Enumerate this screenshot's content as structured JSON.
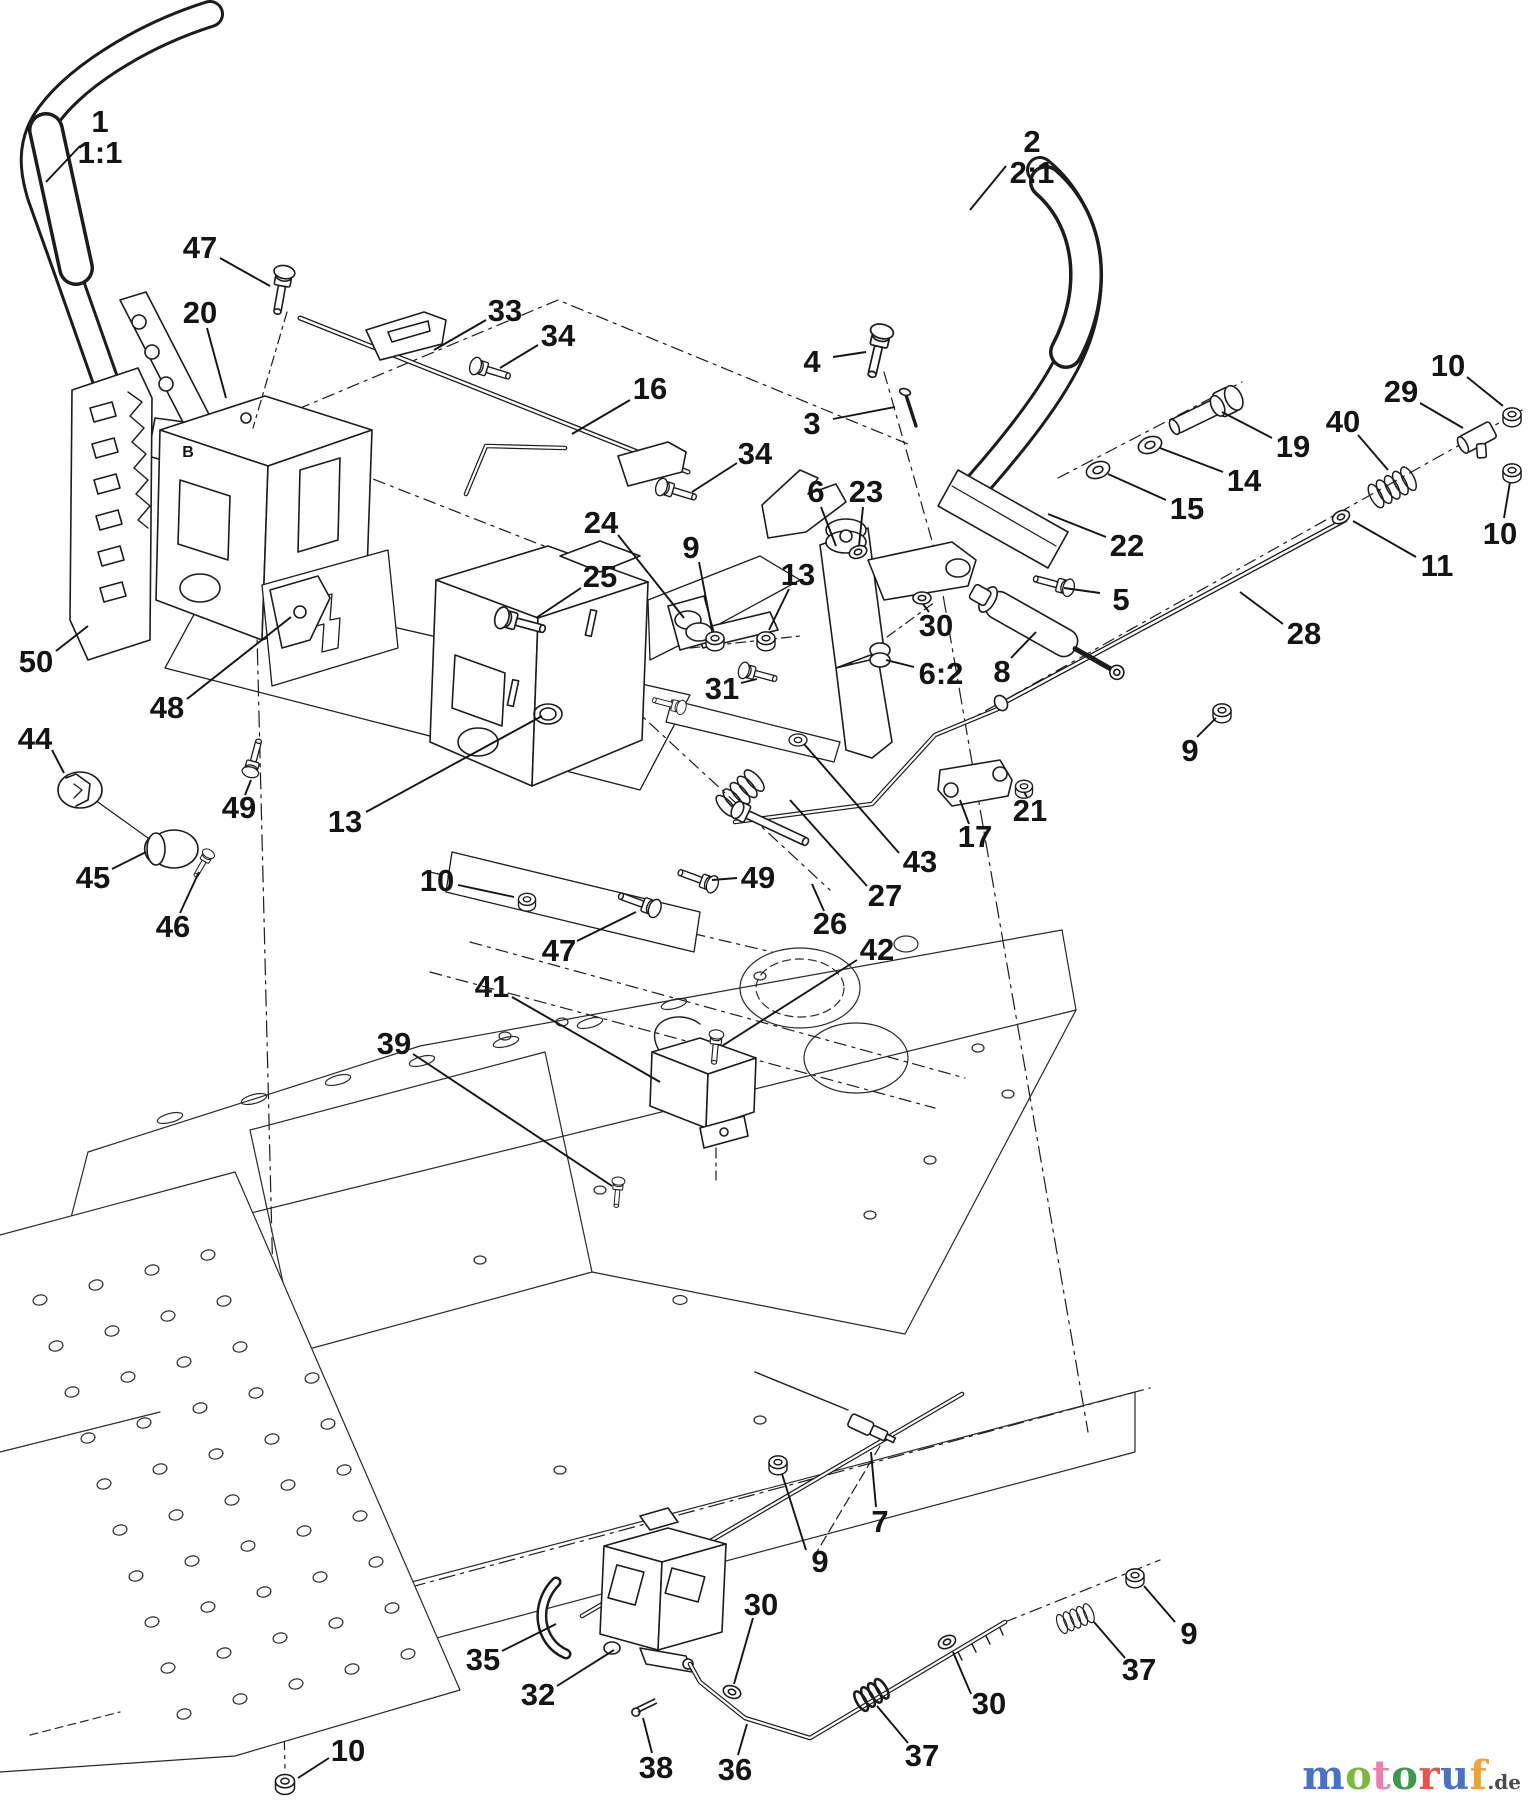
{
  "diagram": {
    "type": "exploded-parts-diagram",
    "background": "#ffffff",
    "line_color": "#1c1c1c",
    "callout_font_px": 31,
    "callouts": [
      {
        "id": "1",
        "lines": [
          "1",
          "1:1"
        ],
        "x": 100,
        "y": 122,
        "leader": [
          80,
          146,
          46,
          182
        ]
      },
      {
        "id": "2",
        "lines": [
          "2",
          "2:1"
        ],
        "x": 1032,
        "y": 142,
        "leader": [
          1006,
          166,
          970,
          210
        ]
      },
      {
        "id": "47a",
        "lines": [
          "47"
        ],
        "x": 200,
        "y": 248,
        "leader": [
          220,
          258,
          270,
          286
        ]
      },
      {
        "id": "20",
        "lines": [
          "20"
        ],
        "x": 200,
        "y": 313,
        "leader": [
          207,
          328,
          226,
          398
        ]
      },
      {
        "id": "33",
        "lines": [
          "33"
        ],
        "x": 505,
        "y": 311,
        "leader": [
          486,
          320,
          434,
          350
        ]
      },
      {
        "id": "34a",
        "lines": [
          "34"
        ],
        "x": 558,
        "y": 336,
        "leader": [
          538,
          345,
          500,
          368
        ]
      },
      {
        "id": "16",
        "lines": [
          "16"
        ],
        "x": 650,
        "y": 389,
        "leader": [
          630,
          400,
          572,
          434
        ]
      },
      {
        "id": "4",
        "lines": [
          "4"
        ],
        "x": 812,
        "y": 362,
        "leader": [
          833,
          357,
          866,
          352
        ]
      },
      {
        "id": "3",
        "lines": [
          "3"
        ],
        "x": 812,
        "y": 424,
        "leader": [
          833,
          419,
          895,
          407
        ]
      },
      {
        "id": "34b",
        "lines": [
          "34"
        ],
        "x": 755,
        "y": 454,
        "leader": [
          737,
          463,
          692,
          492
        ]
      },
      {
        "id": "19",
        "lines": [
          "19"
        ],
        "x": 1293,
        "y": 447,
        "leader": [
          1272,
          438,
          1222,
          412
        ]
      },
      {
        "id": "14",
        "lines": [
          "14"
        ],
        "x": 1244,
        "y": 481,
        "leader": [
          1223,
          472,
          1160,
          448
        ]
      },
      {
        "id": "15",
        "lines": [
          "15"
        ],
        "x": 1187,
        "y": 509,
        "leader": [
          1166,
          500,
          1108,
          474
        ]
      },
      {
        "id": "29",
        "lines": [
          "29"
        ],
        "x": 1401,
        "y": 392,
        "leader": [
          1420,
          403,
          1463,
          428
        ]
      },
      {
        "id": "10a",
        "lines": [
          "10"
        ],
        "x": 1448,
        "y": 366,
        "leader": [
          1467,
          377,
          1503,
          406
        ]
      },
      {
        "id": "40",
        "lines": [
          "40"
        ],
        "x": 1343,
        "y": 422,
        "leader": [
          1358,
          435,
          1388,
          470
        ]
      },
      {
        "id": "10b",
        "lines": [
          "10"
        ],
        "x": 1500,
        "y": 534,
        "leader": [
          1504,
          518,
          1510,
          482
        ]
      },
      {
        "id": "11",
        "lines": [
          "11"
        ],
        "x": 1437,
        "y": 566,
        "leader": [
          1416,
          557,
          1353,
          521
        ]
      },
      {
        "id": "28",
        "lines": [
          "28"
        ],
        "x": 1304,
        "y": 634,
        "leader": [
          1283,
          624,
          1240,
          592
        ]
      },
      {
        "id": "22",
        "lines": [
          "22"
        ],
        "x": 1127,
        "y": 546,
        "leader": [
          1106,
          537,
          1048,
          514
        ]
      },
      {
        "id": "5",
        "lines": [
          "5"
        ],
        "x": 1121,
        "y": 600,
        "leader": [
          1100,
          593,
          1064,
          588
        ]
      },
      {
        "id": "30a",
        "lines": [
          "30"
        ],
        "x": 936,
        "y": 626,
        "leader": [
          929,
          612,
          923,
          604
        ]
      },
      {
        "id": "62",
        "lines": [
          "6:2"
        ],
        "x": 941,
        "y": 674,
        "leader": [
          914,
          667,
          886,
          660
        ]
      },
      {
        "id": "8",
        "lines": [
          "8"
        ],
        "x": 1002,
        "y": 672,
        "leader": [
          1011,
          658,
          1036,
          632
        ]
      },
      {
        "id": "6",
        "lines": [
          "6"
        ],
        "x": 816,
        "y": 492,
        "leader": [
          821,
          507,
          836,
          546
        ]
      },
      {
        "id": "23",
        "lines": [
          "23"
        ],
        "x": 866,
        "y": 492,
        "leader": [
          863,
          507,
          859,
          546
        ]
      },
      {
        "id": "24",
        "lines": [
          "24"
        ],
        "x": 601,
        "y": 523,
        "leader": [
          618,
          535,
          684,
          618
        ]
      },
      {
        "id": "9a",
        "lines": [
          "9"
        ],
        "x": 691,
        "y": 548,
        "leader": [
          699,
          562,
          712,
          630
        ]
      },
      {
        "id": "13a",
        "lines": [
          "13"
        ],
        "x": 798,
        "y": 575,
        "leader": [
          789,
          589,
          769,
          630
        ]
      },
      {
        "id": "25",
        "lines": [
          "25"
        ],
        "x": 600,
        "y": 577,
        "leader": [
          581,
          588,
          536,
          618
        ]
      },
      {
        "id": "31",
        "lines": [
          "31"
        ],
        "x": 722,
        "y": 689,
        "leader": [
          741,
          683,
          757,
          679
        ]
      },
      {
        "id": "21",
        "lines": [
          "21"
        ],
        "x": 1030,
        "y": 811,
        "leader": [
          1027,
          797,
          1024,
          792
        ]
      },
      {
        "id": "17",
        "lines": [
          "17"
        ],
        "x": 975,
        "y": 837,
        "leader": [
          969,
          824,
          960,
          800
        ]
      },
      {
        "id": "43",
        "lines": [
          "43"
        ],
        "x": 920,
        "y": 862,
        "leader": [
          899,
          853,
          804,
          744
        ]
      },
      {
        "id": "27",
        "lines": [
          "27"
        ],
        "x": 885,
        "y": 896,
        "leader": [
          867,
          886,
          790,
          800
        ]
      },
      {
        "id": "26",
        "lines": [
          "26"
        ],
        "x": 830,
        "y": 924,
        "leader": [
          824,
          911,
          812,
          884
        ]
      },
      {
        "id": "49b",
        "lines": [
          "49"
        ],
        "x": 758,
        "y": 878,
        "leader": [
          737,
          878,
          712,
          880
        ]
      },
      {
        "id": "10c",
        "lines": [
          "10"
        ],
        "x": 437,
        "y": 881,
        "leader": [
          458,
          885,
          514,
          897
        ]
      },
      {
        "id": "47b",
        "lines": [
          "47"
        ],
        "x": 559,
        "y": 951,
        "leader": [
          577,
          941,
          636,
          912
        ]
      },
      {
        "id": "42",
        "lines": [
          "42"
        ],
        "x": 877,
        "y": 950,
        "leader": [
          857,
          960,
          722,
          1046
        ]
      },
      {
        "id": "41",
        "lines": [
          "41"
        ],
        "x": 492,
        "y": 987,
        "leader": [
          512,
          997,
          660,
          1082
        ]
      },
      {
        "id": "39",
        "lines": [
          "39"
        ],
        "x": 394,
        "y": 1044,
        "leader": [
          413,
          1054,
          612,
          1186
        ]
      },
      {
        "id": "50",
        "lines": [
          "50"
        ],
        "x": 36,
        "y": 662,
        "leader": [
          56,
          651,
          88,
          626
        ]
      },
      {
        "id": "48",
        "lines": [
          "48"
        ],
        "x": 167,
        "y": 708,
        "leader": [
          187,
          699,
          291,
          617
        ]
      },
      {
        "id": "44",
        "lines": [
          "44"
        ],
        "x": 35,
        "y": 739,
        "leader": [
          52,
          750,
          64,
          773
        ]
      },
      {
        "id": "45",
        "lines": [
          "45"
        ],
        "x": 93,
        "y": 878,
        "leader": [
          112,
          869,
          146,
          852
        ]
      },
      {
        "id": "46",
        "lines": [
          "46"
        ],
        "x": 173,
        "y": 927,
        "leader": [
          180,
          913,
          199,
          872
        ]
      },
      {
        "id": "49a",
        "lines": [
          "49"
        ],
        "x": 239,
        "y": 808,
        "leader": [
          245,
          795,
          251,
          780
        ]
      },
      {
        "id": "13b",
        "lines": [
          "13"
        ],
        "x": 345,
        "y": 822,
        "leader": [
          366,
          812,
          542,
          716
        ]
      },
      {
        "id": "9c",
        "lines": [
          "9"
        ],
        "x": 1190,
        "y": 751,
        "leader": [
          1197,
          737,
          1216,
          718
        ]
      },
      {
        "id": "7",
        "lines": [
          "7"
        ],
        "x": 880,
        "y": 1522,
        "leader": [
          876,
          1507,
          871,
          1452
        ]
      },
      {
        "id": "9d",
        "lines": [
          "9"
        ],
        "x": 820,
        "y": 1562,
        "leader": [
          806,
          1550,
          782,
          1474
        ]
      },
      {
        "id": "35",
        "lines": [
          "35"
        ],
        "x": 483,
        "y": 1660,
        "leader": [
          502,
          1651,
          556,
          1624
        ]
      },
      {
        "id": "32",
        "lines": [
          "32"
        ],
        "x": 538,
        "y": 1695,
        "leader": [
          557,
          1686,
          614,
          1650
        ]
      },
      {
        "id": "38",
        "lines": [
          "38"
        ],
        "x": 656,
        "y": 1768,
        "leader": [
          652,
          1753,
          643,
          1718
        ]
      },
      {
        "id": "36",
        "lines": [
          "36"
        ],
        "x": 735,
        "y": 1770,
        "leader": [
          738,
          1755,
          747,
          1724
        ]
      },
      {
        "id": "30b",
        "lines": [
          "30"
        ],
        "x": 761,
        "y": 1605,
        "leader": [
          753,
          1618,
          734,
          1684
        ]
      },
      {
        "id": "37a",
        "lines": [
          "37"
        ],
        "x": 922,
        "y": 1756,
        "leader": [
          908,
          1743,
          877,
          1706
        ]
      },
      {
        "id": "30c",
        "lines": [
          "30"
        ],
        "x": 989,
        "y": 1704,
        "leader": [
          971,
          1694,
          953,
          1652
        ]
      },
      {
        "id": "9b",
        "lines": [
          "9"
        ],
        "x": 1189,
        "y": 1634,
        "leader": [
          1175,
          1622,
          1144,
          1586
        ]
      },
      {
        "id": "37b",
        "lines": [
          "37"
        ],
        "x": 1139,
        "y": 1670,
        "leader": [
          1125,
          1658,
          1094,
          1622
        ]
      },
      {
        "id": "10d",
        "lines": [
          "10"
        ],
        "x": 348,
        "y": 1751,
        "leader": [
          329,
          1758,
          298,
          1778
        ]
      }
    ],
    "reference_marks": [
      {
        "text": "B",
        "x": 188,
        "y": 452
      }
    ]
  },
  "watermark": {
    "word": "motoruf",
    "suffix": ".de",
    "letter_colors": [
      "#4a71c4",
      "#7cb93e",
      "#e87fb0",
      "#3d9a4c",
      "#e2554a",
      "#4a71c4",
      "#eda23c"
    ],
    "suffix_color": "#4a4a4a"
  }
}
